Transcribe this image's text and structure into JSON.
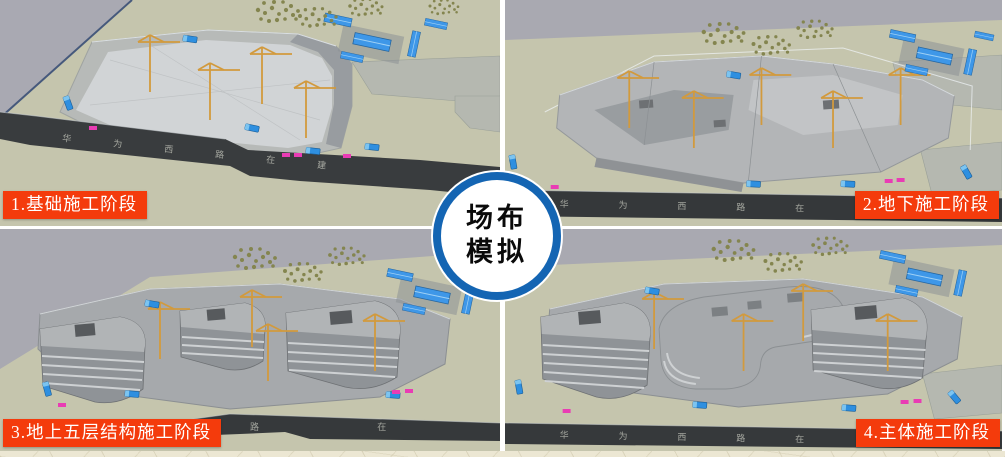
{
  "title_badge": {
    "line1": "场布",
    "line2": "模拟"
  },
  "phases": [
    {
      "label": "1.基础施工阶段",
      "road_text": "华 为 西 路 在 建"
    },
    {
      "label": "2.地下施工阶段",
      "road_text": "华 为 西 路 在"
    },
    {
      "label": "3.地上五层结构施工阶段",
      "road_text": "路 在 建"
    },
    {
      "label": "4.主体施工阶段",
      "road_text": "华 为 西 路 在"
    }
  ],
  "colors": {
    "label_background": "#f43b0c",
    "label_text": "#ffffff",
    "badge_ring": "#1465b3",
    "badge_background": "#ffffff",
    "badge_text": "#0a0a0a",
    "terrain_beige": "#c5c5ad",
    "background_grey": "#a9a9b1",
    "pit_floor_grey": "#d1d4d6",
    "structure_grey": "#b3b5b7",
    "building_face_grey": "#8f9397",
    "road_dark": "#36393b",
    "crane_orange": "#d29a3d",
    "vehicle_blue": "#2e8fe0",
    "office_roof_blue": "#3e97e8",
    "marker_magenta": "#e93cb4",
    "tree_olive": "#84854f",
    "page_pattern_beige": "#ece7d3"
  }
}
